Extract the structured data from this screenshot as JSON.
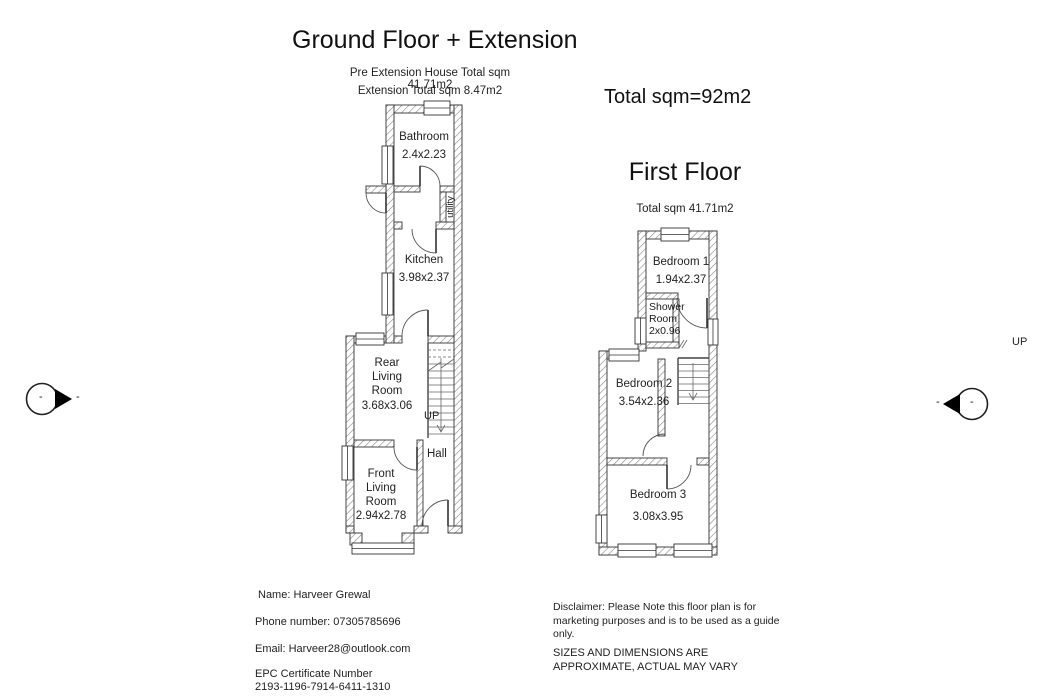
{
  "header": {
    "ground_title": "Ground Floor + Extension",
    "pre_extension_total": "Pre Extension House Total sqm 41.71m2",
    "extension_total": "Extension Total sqm 8.47m2",
    "overall_total": "Total sqm=92m2",
    "first_title": "First Floor",
    "first_total": "Total sqm 41.71m2"
  },
  "ground_floor": {
    "rooms": {
      "bathroom": {
        "name": "Bathroom",
        "dims": "2.4x2.23"
      },
      "utility": {
        "name": "utility"
      },
      "kitchen": {
        "name": "Kitchen",
        "dims": "3.98x2.37"
      },
      "rear_living": {
        "name": "Rear Living Room",
        "dims": "3.68x3.06"
      },
      "front_living": {
        "name": "Front Living Room",
        "dims": "2.94x2.78"
      },
      "hall": {
        "name": "Hall"
      }
    },
    "stairs_label": "UP"
  },
  "first_floor": {
    "rooms": {
      "bedroom1": {
        "name": "Bedroom 1",
        "dims": "1.94x2.37"
      },
      "shower": {
        "name": "Shower Room",
        "dims": "2x0.96"
      },
      "bedroom2": {
        "name": "Bedroom 2",
        "dims": "3.54x2.36"
      },
      "bedroom3": {
        "name": "Bedroom 3",
        "dims": "3.08x3.95"
      }
    },
    "stairs_label": "UP"
  },
  "markers": {
    "left_inner_dash": "-",
    "left_outer_dash": "-",
    "right_inner_dash": "-",
    "right_outer_dash": "-"
  },
  "contact": {
    "name": "Name: Harveer Grewal",
    "phone": "Phone number: 07305785696",
    "email": "Email: Harveer28@outlook.com",
    "epc_line1": "EPC Certificate Number",
    "epc_line2": "2193-1196-7914-6411-1310"
  },
  "disclaimer": {
    "marketing": "Disclaimer: Please Note this floor plan is for marketing purposes and is to be used as a guide only.",
    "sizes": "SIZES AND DIMENSIONS ARE APPROXIMATE, ACTUAL MAY VARY"
  },
  "colors": {
    "ink": "#1a1a1a",
    "wall_outline": "#333333",
    "hatch": "#888888"
  }
}
